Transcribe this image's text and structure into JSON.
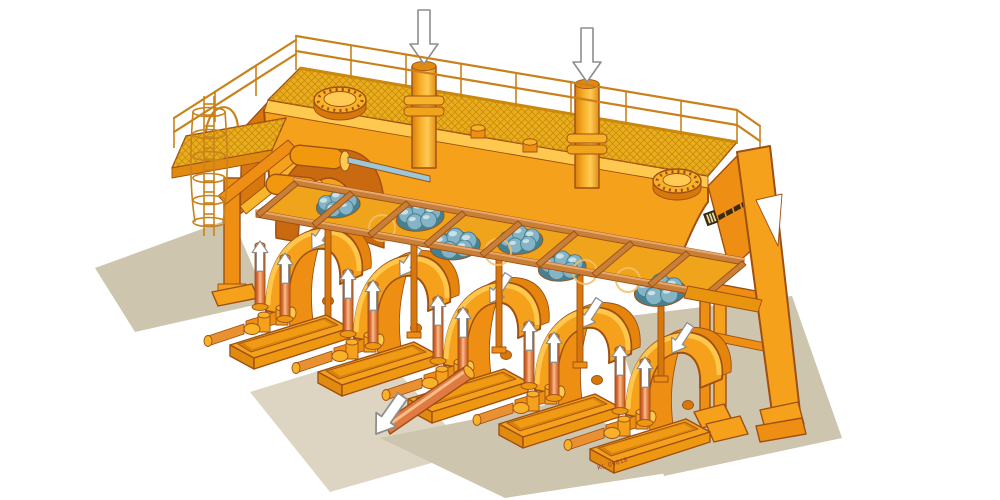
{
  "figure": {
    "drawing_number": "KL 09818",
    "manufacturer_logo": "striped-square-mark-with-italic-wordmark"
  },
  "components": {
    "inlet_pipes": {
      "count": 2,
      "arrow_icon": "flow-down-arrow-icon"
    },
    "drive_units": {
      "count": 5,
      "candle_arrow_icon": "flow-up-arrow-icon",
      "drum_arrow_icon": "motion-arrow-icon"
    },
    "discharge": {
      "count": 1,
      "arrow_icon": "discharge-arrow-icon"
    },
    "manhole_covers": {
      "count": 2
    },
    "bar_bundles": {
      "count": 6
    },
    "roller_frame_crossbars": {
      "count": 9
    },
    "access": {
      "ladder": 1,
      "platform": 1,
      "railings": 1
    }
  },
  "arrows": {
    "inlet_down": 2,
    "candle_up": 10,
    "drum_motion": 5,
    "discharge_out": 1
  },
  "palette": {
    "background": "#ffffff",
    "outline": "#9e5014",
    "orange": "#f5a11b",
    "orange_mid": "#ee8e12",
    "orange_deep": "#d8780c",
    "orange_dark": "#c0660a",
    "yellow": "#ffc94f",
    "pale": "#ffe9a8",
    "grating": "#e9ae1c",
    "grating_line": "#c9880e",
    "railing": "#c9821b",
    "blue_light": "#c9e0e6",
    "blue": "#85b4c6",
    "blue_dark": "#47808f",
    "steel": "#9cc6da",
    "coil": "#f3c068",
    "arrow_fill": "#ffffff",
    "arrow_outline": "#8d8d8d",
    "shadow": "#cec5af",
    "shadow_light": "#ddd5c2",
    "label_red": "#a03a1e",
    "logo_dark": "#3a2a12"
  }
}
